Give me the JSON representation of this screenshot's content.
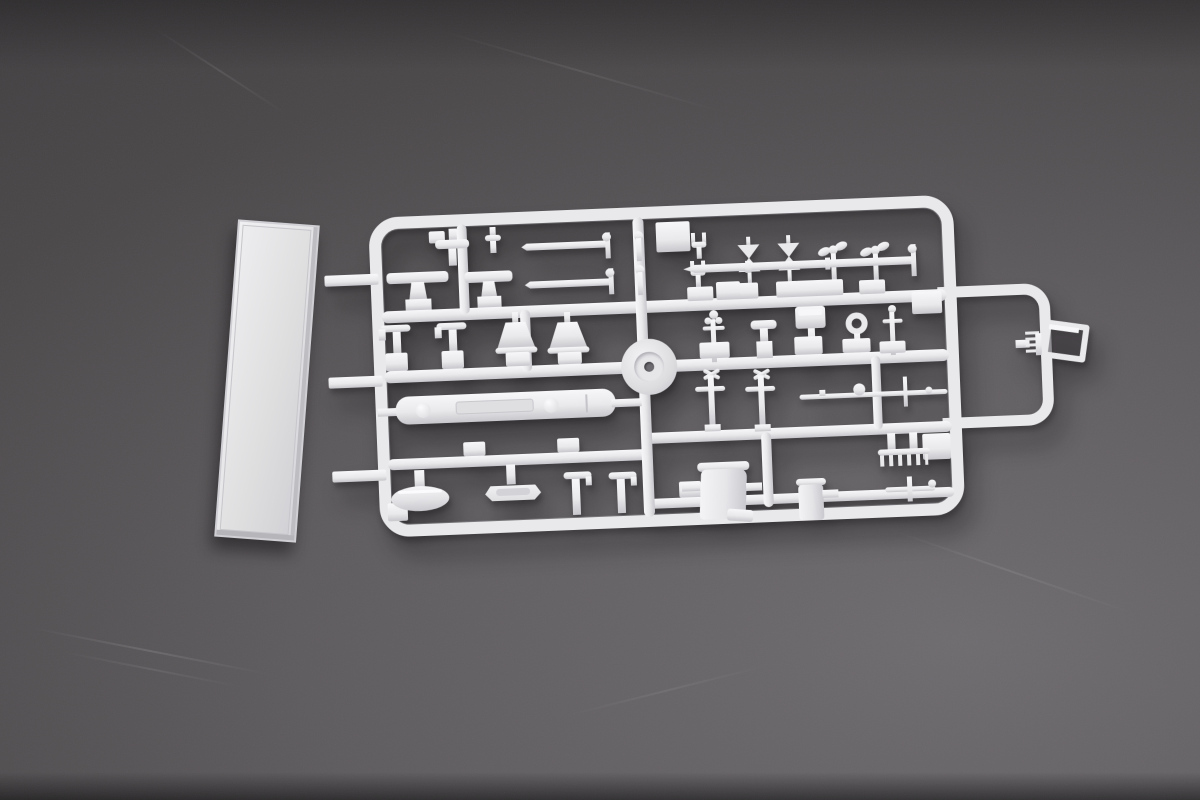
{
  "scene": {
    "description": "Photograph of a white injection-molded polystyrene model kit sprue (parts tree) of small ship fittings, with a long rectangular deck plate attached at the left, lying on a dark gray scratched studio background",
    "colors": {
      "bg1": "#3d3b3d",
      "bg2": "#4b484a",
      "bg3": "#5f5c5f",
      "bg4": "#6f6c70",
      "plastic": "#e9e9eb",
      "plastic-light": "#f7f7f9",
      "plastic-dark": "#c7c7cc",
      "plastic-deep": "#aeaeb4",
      "hole": "#6e6c70"
    },
    "inventory": [
      "rectangular deck plate",
      "rounded sprue frame with runner grid and right-hand runner loop",
      "gun barrels (2)",
      "bowtie valve handles (2)",
      "propeller heads (2)",
      "anchor claws (2)",
      "platform tables (2)",
      "J-hook davits (4)",
      "lampshade ventilators (2)",
      "capstan disc",
      "valve wheels (3)",
      "bollard",
      "searchlight box",
      "life ring",
      "long boom part with panel detail",
      "yard rod",
      "oval boat hull",
      "ship's boat",
      "funnel drum",
      "winch cylinder",
      "ladder comb",
      "cross spar",
      "bracket fitting on loop"
    ]
  }
}
